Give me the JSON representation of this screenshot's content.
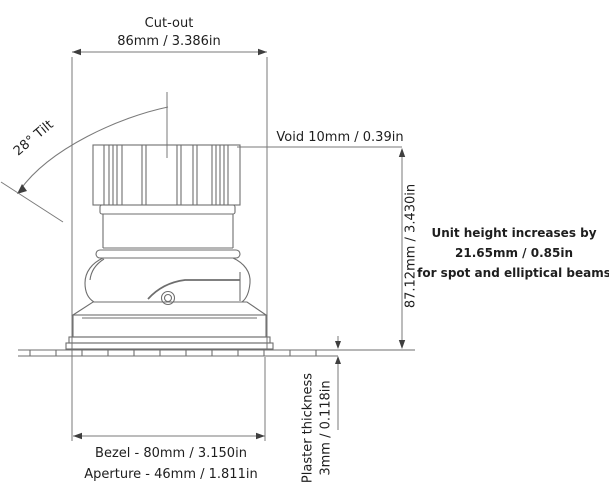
{
  "title": "Recessed downlight dimensions drawing",
  "colors": {
    "background": "#ffffff",
    "drawing_line": "#6e6e6e",
    "dimension_line": "#7a7a7a",
    "arrow": "#3f3f3f",
    "text": "#1e1e1e"
  },
  "dimensions": {
    "cutout_label": "Cut-out",
    "cutout_value": "86mm / 3.386in",
    "tilt": "28° Tilt",
    "void": "Void 10mm / 0.39in",
    "unit_height": "87.12mm / 3.430in",
    "bezel": "Bezel - 80mm / 3.150in",
    "aperture": "Aperture - 46mm / 1.811in",
    "plaster_line1": "Plaster thickness",
    "plaster_line2": "3mm / 0.118in"
  },
  "note": {
    "line1": "Unit height increases by",
    "line2": "21.65mm / 0.85in",
    "line3": "for spot and elliptical beams"
  }
}
